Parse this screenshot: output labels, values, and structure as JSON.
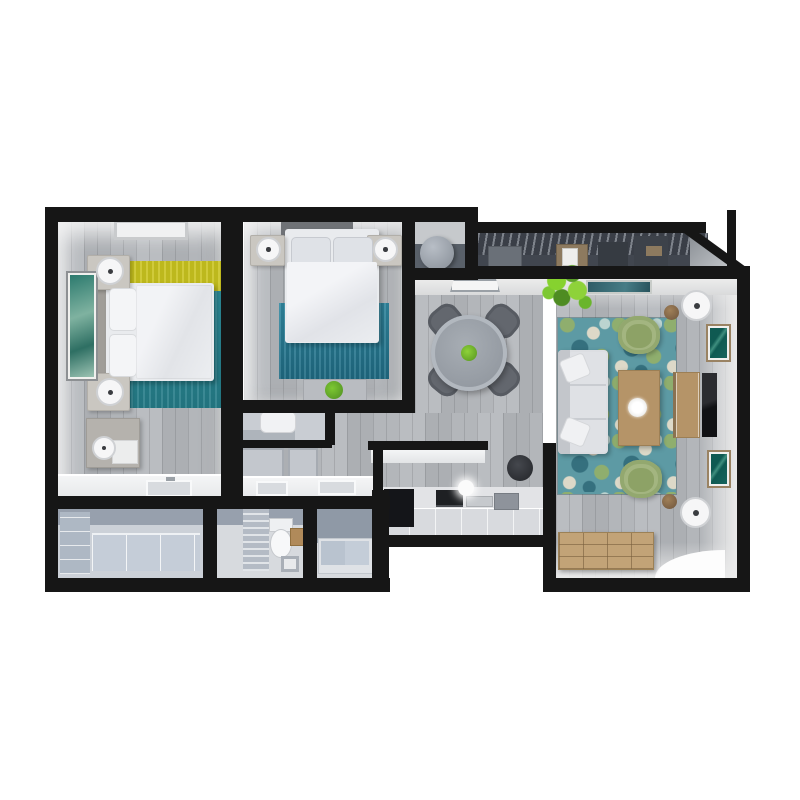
{
  "scene": {
    "type": "3d-floorplan-top-down-render",
    "description": "Two-bedroom apartment 3D floor plan viewed from above on a white background",
    "background_color": "#ffffff",
    "wall_color": "#161616",
    "wood_floor_color": "#b4b7bb",
    "bath_floor_color": "#d7dade",
    "balcony_floor_color": "#41464f"
  },
  "palette": {
    "rug_teal": "#2a8c99",
    "rug_yellow": "#c9c31f",
    "bedroom2_rug_blue": "#2c7e95",
    "living_rug_base": "#5d9aa4",
    "sofa_gray": "#dcdee2",
    "accent_chair_green": "#a3b580",
    "plant_green": "#7dc832",
    "wood_furniture": "#b59468",
    "tv_black": "#1c1d20",
    "dining_table_gray": "#949aa2",
    "dining_chair_gray": "#62666d",
    "kitchen_appliance_black": "#141519",
    "bathtub_gray_blue": "#b9c3cf",
    "cabinet_gray_blue": "#b6bfca",
    "window_glass_teal": "#2e5c66"
  },
  "rooms": [
    {
      "id": "master-bedroom",
      "label": "Master bedroom",
      "furniture": [
        "double bed with white duvet",
        "gray headboard",
        "two nightstands with round lamps",
        "framed teal wall art",
        "dresser with cylinder lamp and towels",
        "ceiling skylight",
        "teal rug with yellow band",
        "vanity counter with sink"
      ]
    },
    {
      "id": "bedroom-2",
      "label": "Bedroom 2",
      "furniture": [
        "double bed with white duvet",
        "dark headboard",
        "two nightstands with round lamps",
        "blue rug",
        "bench with potted plant"
      ]
    },
    {
      "id": "utility-closet",
      "label": "Utility closet",
      "furniture": [
        "round water heater"
      ]
    },
    {
      "id": "balcony",
      "label": "Balcony with pergola slats",
      "furniture": [
        "wood shelf with picture",
        "dark storage panels",
        "door mat"
      ]
    },
    {
      "id": "dining-area",
      "label": "Dining area",
      "furniture": [
        "round gray table with plant centerpiece",
        "four gray chairs",
        "entry door mat"
      ]
    },
    {
      "id": "living-room",
      "label": "Living room",
      "furniture": [
        "three-seat gray sofa with pillows",
        "two green accent chairs",
        "wood coffee table with white centerpiece",
        "floral teal rug",
        "wood TV console",
        "wall-mounted TV",
        "two framed artworks",
        "two disc floor lamps with stools",
        "green plant",
        "slatted wood sideboard",
        "open door light",
        "teal window pane"
      ]
    },
    {
      "id": "kitchen",
      "label": "Kitchen",
      "furniture": [
        "island counter",
        "black cooktop block",
        "oven",
        "tray",
        "gray appliance",
        "lower cabinets",
        "black stool",
        "white pendant sphere"
      ]
    },
    {
      "id": "hall-vanity",
      "label": "Hallway vanity",
      "furniture": [
        "double-sink counter",
        "wall frames",
        "washer niche with shelf"
      ]
    },
    {
      "id": "storage-room",
      "label": "Storage room",
      "furniture": [
        "gray-blue cabinet units"
      ]
    },
    {
      "id": "toilet-room",
      "label": "Toilet room",
      "furniture": [
        "toilet",
        "glass partition",
        "wood stool",
        "small sink"
      ]
    },
    {
      "id": "bathtub-room",
      "label": "Bathtub room",
      "furniture": [
        "two-section bathtub"
      ]
    }
  ]
}
